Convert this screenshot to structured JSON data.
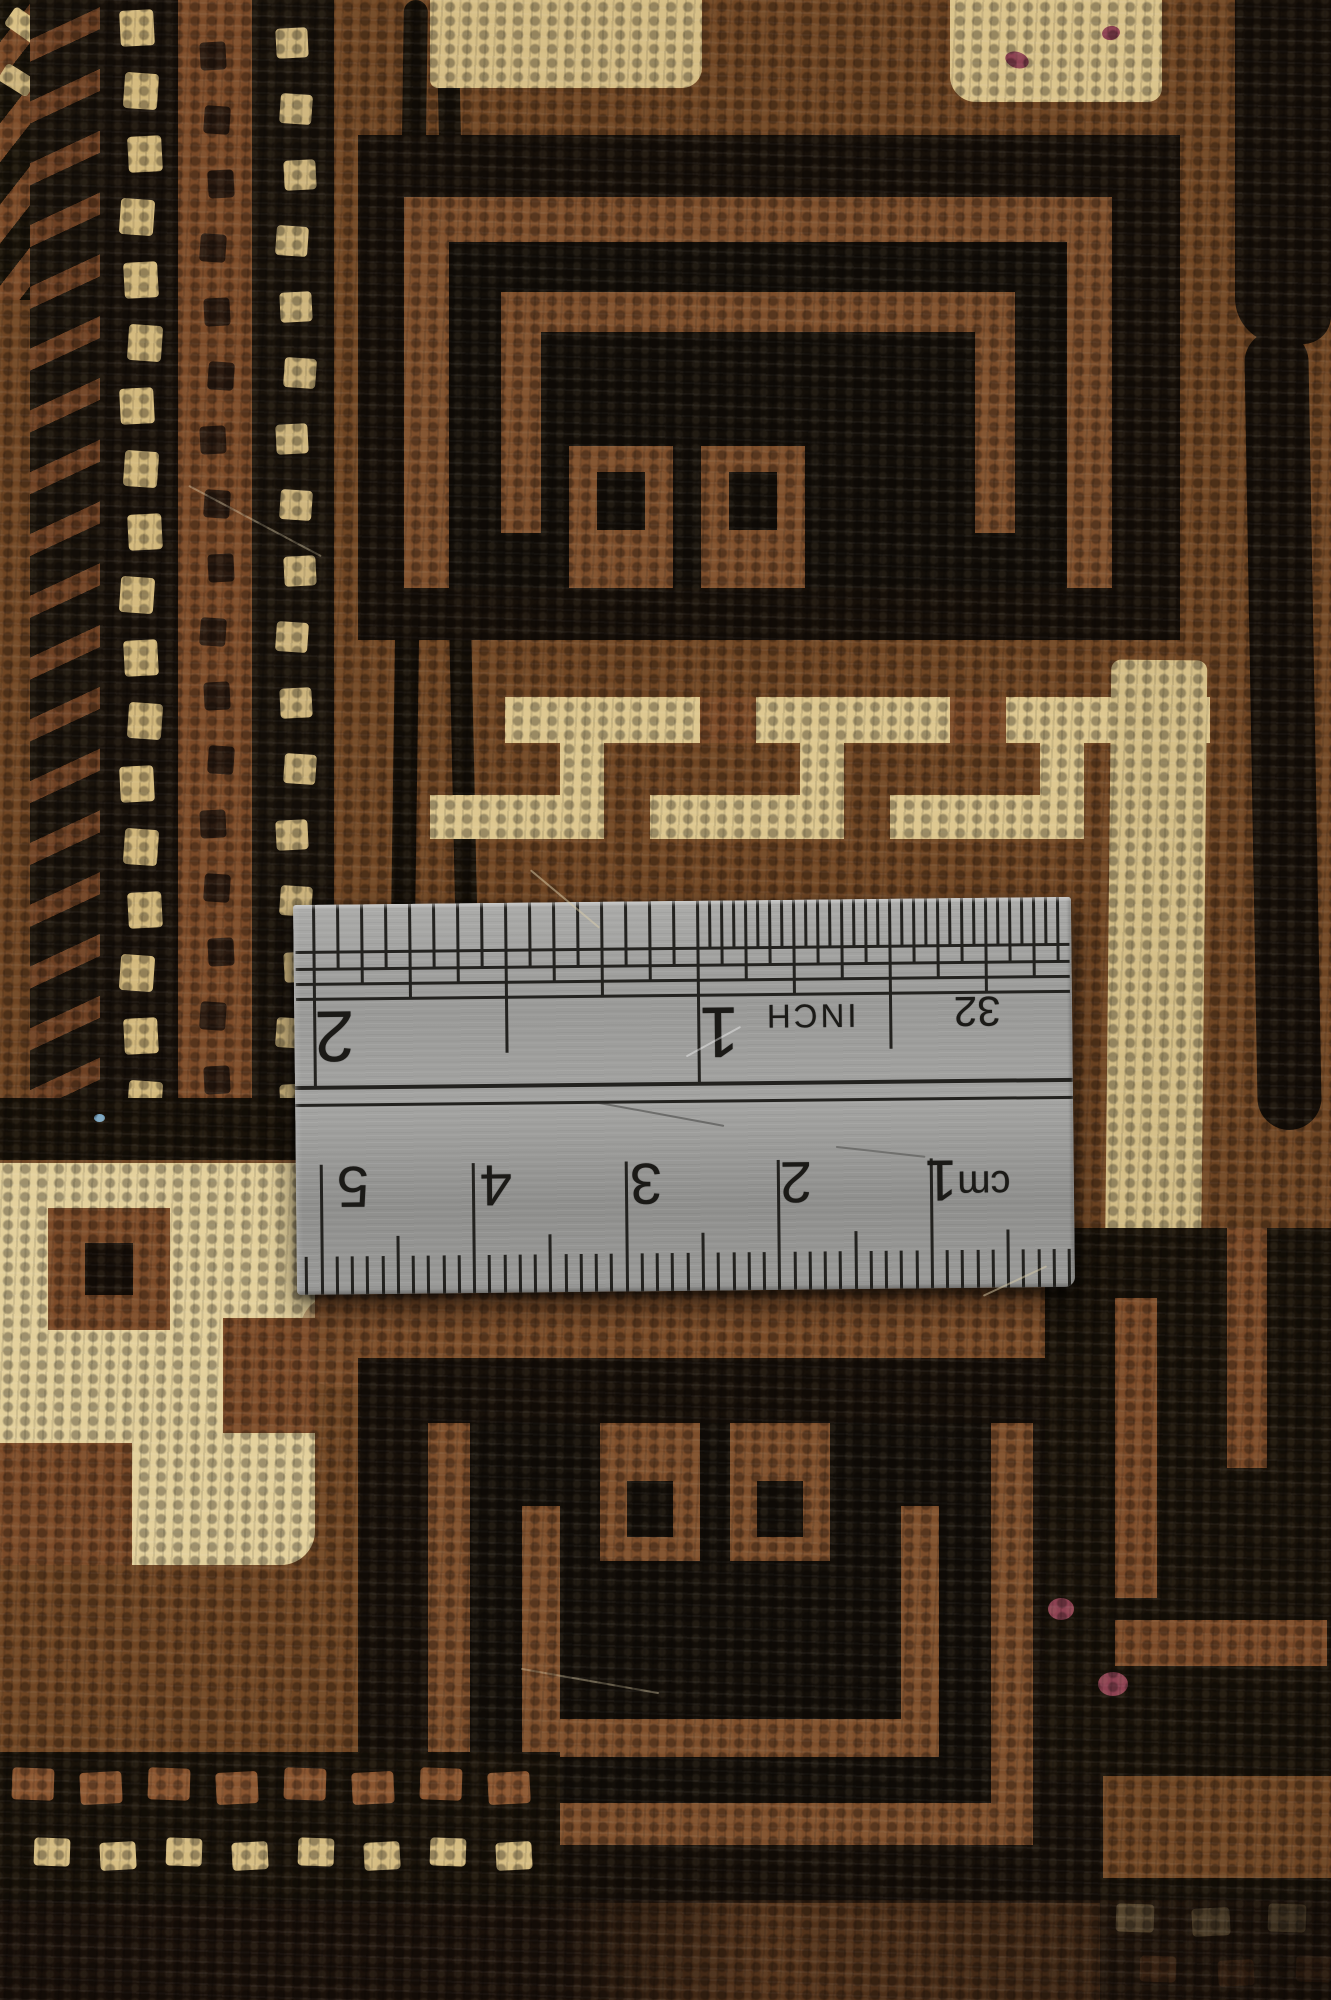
{
  "ruler": {
    "inch_scale": {
      "unit_label": "INCH",
      "fraction_label": "32",
      "numbers": [
        "1",
        "2"
      ]
    },
    "cm_scale": {
      "unit_label": "cm",
      "numbers": [
        "1",
        "2",
        "3",
        "4",
        "5"
      ]
    }
  },
  "palette": {
    "field_brown": "#6f4523",
    "motif_brown": "#7d4e2b",
    "black_wool": "#171009",
    "cream": "#d9c084",
    "bright_cream": "#e2cf9b",
    "maroon": "#8d4252",
    "blue_fiber": "#7ba7c4",
    "steel": "#9e9e9c",
    "marking": "#23221f"
  }
}
